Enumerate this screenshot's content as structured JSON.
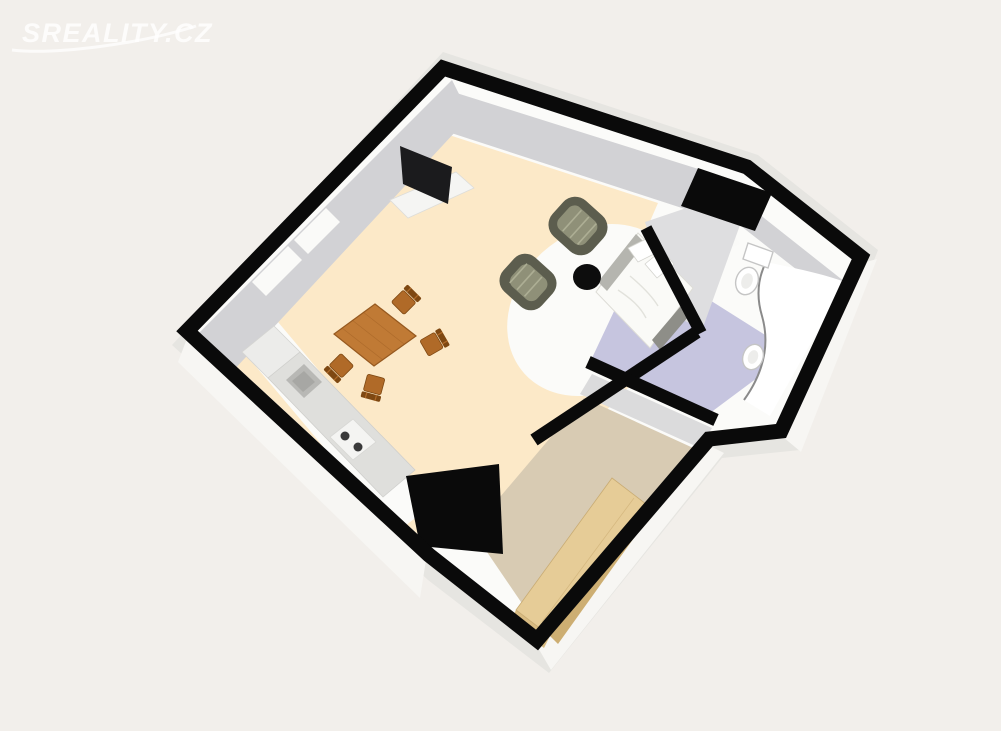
{
  "watermark": {
    "text": "SREALITY.CZ"
  },
  "colors": {
    "bg": "#F2EFEB",
    "outer_face": "#E6E5E1",
    "outer_bright": "#F7F6F3",
    "wall": "#0A0A0A",
    "wall_inner": "#D2D2D5",
    "wall_inner_light": "#DEDEE0",
    "floor_white": "#FBFBF9",
    "floor_living": "#FCE9C8",
    "floor_bath": "#C6C5DF",
    "floor_hall": "#D8CBB3",
    "hall_band": "#DBDBDC",
    "window": "#FAFAF8",
    "counter": "#DFDFDC",
    "counter_light": "#ECECEA",
    "sink": "#B8B8B5",
    "stove": "#F4F4F2",
    "burner": "#3A3A3A",
    "table_wood": "#C07A35",
    "table_edge": "#96591F",
    "chair_wood": "#B06A28",
    "chair_back": "#7E4812",
    "armchair_body": "#5C5D4E",
    "armchair_seat": "#8F9078",
    "armchair_stripe": "#B3B49A",
    "coffee_table": "#0D0D0D",
    "bed_white": "#FAFAF7",
    "bed_rail": "#B5B5AF",
    "bed_footer": "#8E8E88",
    "fixture": "#FFFFFF",
    "fixture_edge": "#C5C5C5",
    "fixture_inner": "#EDEDEB",
    "tub_line": "#8A8A8A",
    "wardrobe_top": "#E6CC97",
    "wardrobe_front": "#CDAE72",
    "wardrobe_end": "#D8BB82",
    "tv": "#1B1B1D",
    "tv_stand": "#F5F5F3",
    "watermark": "#FFFFFF"
  }
}
